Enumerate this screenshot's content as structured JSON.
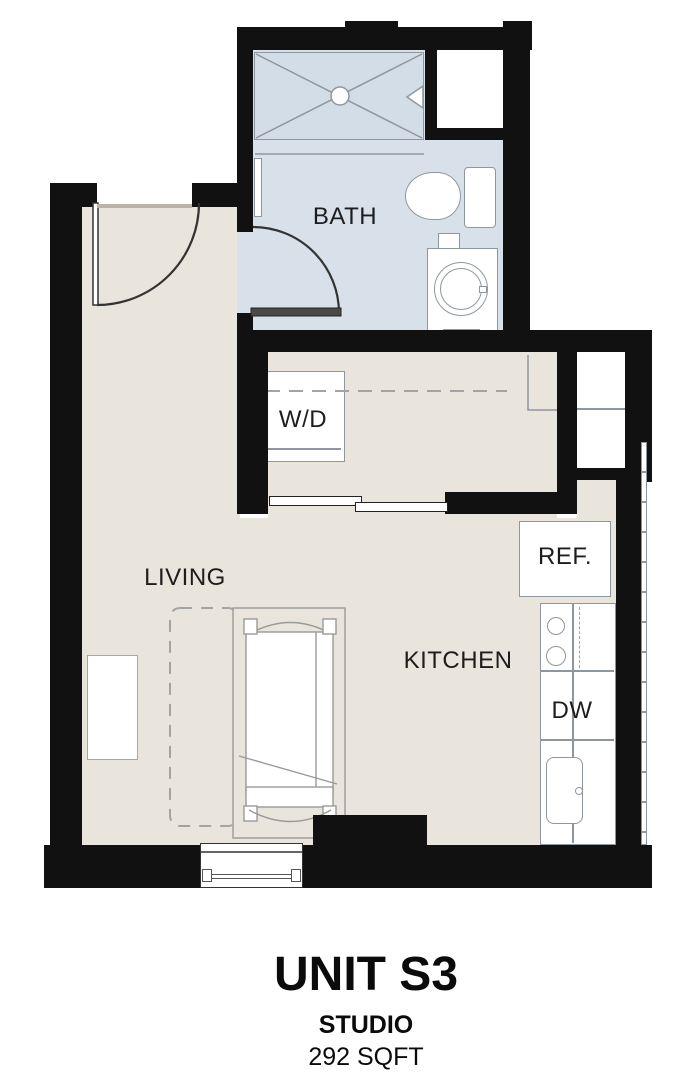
{
  "plan": {
    "unit_title": "UNIT S3",
    "unit_type": "STUDIO",
    "unit_area": "292 SQFT",
    "labels": {
      "bath": "BATH",
      "living": "LIVING",
      "kitchen": "KITCHEN",
      "washer_dryer": "W/D",
      "refrigerator": "REF.",
      "dishwasher": "DW"
    },
    "colors": {
      "wall": "#111111",
      "floor": "#eae5dc",
      "bath_floor": "#d8e1ea",
      "shower_fill": "#d3dde8",
      "fixture_line": "#8f979e",
      "door_line": "#333333",
      "dash_line": "#a3a3a3",
      "label": "#1d1d1d"
    }
  }
}
